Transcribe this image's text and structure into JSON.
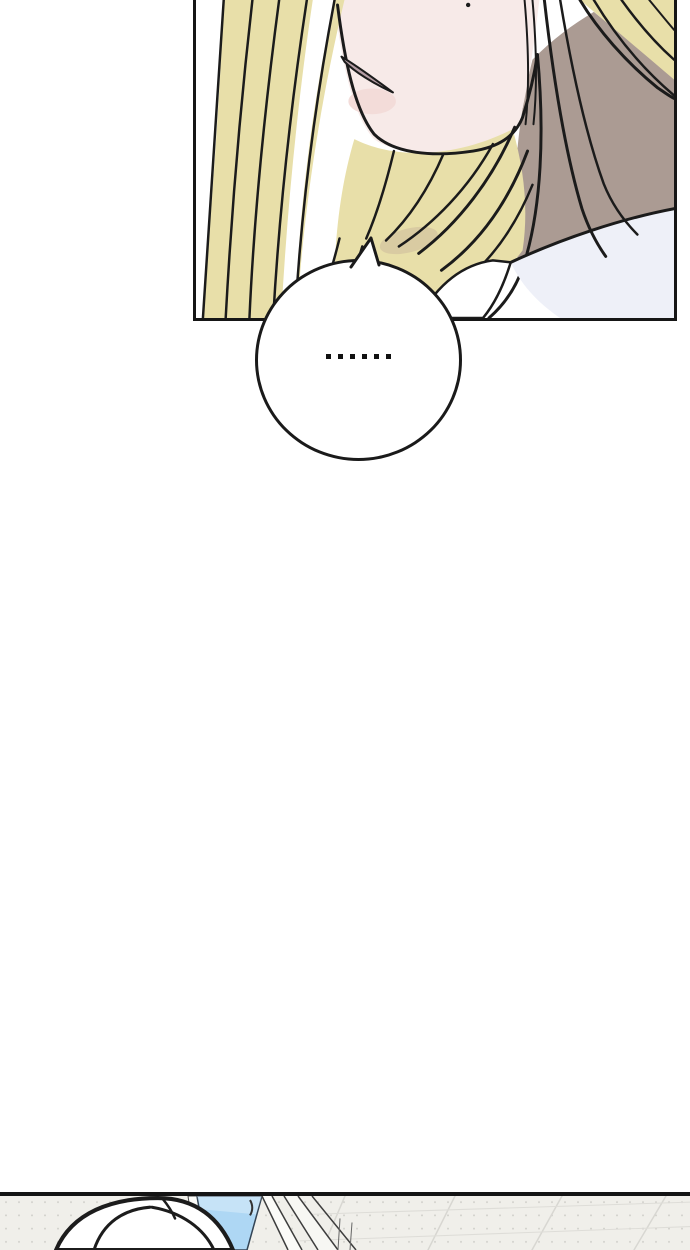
{
  "page": {
    "width_px": 690,
    "height_px": 1250,
    "background": "#ffffff",
    "kind": "vertical webtoon comic strip segment"
  },
  "panel_portrait": {
    "description": "Close-up of the lower half of a blonde character's face: closed slanted lips, small beauty mark on the chin, shadowed neck, white collar; long pale-blonde hair strands sweep across both sides. Panel is cropped by the top edge of the image.",
    "border_color": "#161616",
    "colors": {
      "skin": "#f7eae8",
      "blush": "#f3dcd9",
      "hair": "#e8dfa9",
      "hair_shadow": "#d9cba2",
      "neck_shadow": "#ab9b93",
      "lips": "#b49da4",
      "clothing": "#eef0f8",
      "collar_white": "#ffffff",
      "linework": "#1b1b1b"
    }
  },
  "speech_bubble": {
    "text": "……",
    "dot_count": 6,
    "shape": "circle with small pointed tail toward the speaker",
    "fill": "#ffffff",
    "stroke": "#1a1a1a",
    "dot_color": "#111111"
  },
  "panel_scene": {
    "description": "Top sliver of the next panel: the crown of a white-haired head in front of a bright window with blue sky and angled white frames; a faint tiled wall-ceiling grid recedes to the right. Panel is cropped by the bottom edge of the image.",
    "border_color": "#141414",
    "colors": {
      "wall": "#f0efea",
      "grid_line": "#d8d7d2",
      "sky": "#aed7f4",
      "frame": "#fbfbf8",
      "head_fill": "#ffffff",
      "linework": "#1c1c1c"
    }
  }
}
